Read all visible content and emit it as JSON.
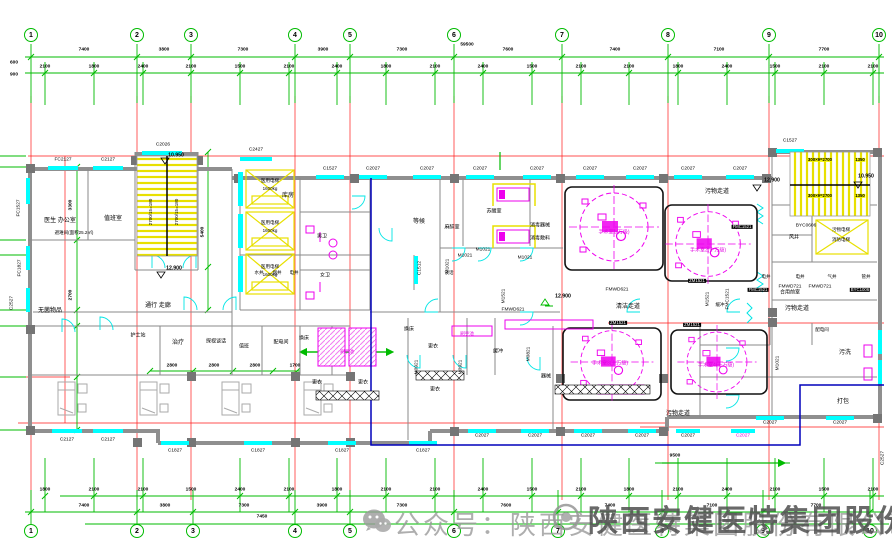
{
  "grid_numbers": [
    "1",
    "2",
    "3",
    "4",
    "5",
    "6",
    "7",
    "8",
    "9",
    "10"
  ],
  "dims": {
    "total": "59500",
    "row1": [
      "7400",
      "3800",
      "7300",
      "3900",
      "7300",
      "7600",
      "7400",
      "7100",
      "7700"
    ],
    "row2": [
      "2100",
      "1800",
      "2400",
      "2100",
      "1500",
      "2100",
      "2400",
      "1800",
      "2100",
      "2400",
      "1500",
      "2100",
      "2100",
      "1800",
      "2400",
      "1500",
      "2100",
      "2100"
    ],
    "bottom_small": [
      "1800",
      "2100",
      "2100",
      "1500",
      "2400",
      "2100",
      "1800",
      "2100",
      "2100",
      "2400",
      "1500",
      "2100",
      "1800",
      "2100",
      "2400",
      "2100",
      "1500",
      "2100"
    ],
    "bottom_spans": [
      "7400",
      "3800",
      "7300",
      "3900",
      "7300",
      "7600",
      "7400",
      "7100",
      "7700"
    ],
    "mid": [
      "2800",
      "2800",
      "2800",
      "1700"
    ],
    "or_area": "9500",
    "left_a": "600",
    "left_b": "900",
    "bottom_extra": "7450",
    "vert": [
      "3300",
      "2700",
      "5400"
    ],
    "stair_top": [
      "300×9=2700",
      "1350",
      "300×9=2700",
      "1350"
    ],
    "stair_left": "2700/15=180"
  },
  "levels": [
    "10.950",
    "12.900",
    "12.900",
    "12.900",
    "10.950"
  ],
  "windows_top": [
    "FC2127",
    "C2127",
    "C2026",
    "C2427",
    "C1527",
    "C2027",
    "C2027",
    "C2027",
    "C2027",
    "C2027",
    "C2027",
    "C2027",
    "C2027",
    "C1527"
  ],
  "windows_bottom": [
    "C2127",
    "C2127",
    "C1827",
    "C1827",
    "C1827",
    "C1827",
    "C2027",
    "C2027",
    "C2027",
    "C2027",
    "C2027",
    "C2027",
    "C2027",
    "C2027"
  ],
  "windows_side": [
    "FC1527",
    "FC1827",
    "C2527",
    "C1512",
    "C2527"
  ],
  "doors": [
    "M1021",
    "M1021",
    "M1021",
    "M1021",
    "M1521",
    "FMWD621",
    "FMWD621",
    "M0921",
    "M0921",
    "M0821",
    "M1521",
    "FMC1521",
    "ZM1521",
    "ZM1521",
    "ZM1521",
    "FMC1521",
    "BYC0606",
    "FMC1521",
    "FMWD721",
    "FMWD721",
    "BYC1006",
    "M1021"
  ],
  "rooms": [
    "医生 办公室",
    "避难间(面积25.2㎡)",
    "值班室",
    "无菌物品",
    "通行 走廊",
    "护士站",
    "治疗",
    "探视谈话",
    "值班",
    "配电间",
    "换床",
    "换床",
    "库房",
    "男卫",
    "女卫",
    "水井",
    "烟井",
    "电井",
    "等候",
    "麻醉室",
    "苏醒室",
    "消毒器械",
    "消毒敷料",
    "手术室1(万级)",
    "手术室2(十万级)",
    "清洁走道",
    "污物走道",
    "污物走道",
    "污物走道",
    "风井",
    "合用前室",
    "污物电梯",
    "消防电梯",
    "电井",
    "电井",
    "气井",
    "管井",
    "污洗",
    "打包",
    "配电间",
    "缓冲",
    "缓冲",
    "器械",
    "更衣",
    "更衣",
    "更衣",
    "更衣",
    "谈话",
    "手术室3(十万级)",
    "手术室4(十万级)",
    "医用电梯",
    "1600kg",
    "医用电梯",
    "1600kg",
    "医用电梯",
    "1600kg",
    "刷手池",
    "刷手池"
  ],
  "watermark": {
    "wechat": "公众号：陕西安健医特集团股份有限公司",
    "company": "陕西安健医特集团股份有限公司"
  },
  "colors": {
    "grid_green": "#00bb00",
    "axis_red": "#ff0000",
    "window_cyan": "#00ffff",
    "equip_magenta": "#ee00ee",
    "stair_yellow": "#e8e000",
    "clean_zone_blue": "#0000bb",
    "wall_gray": "#8a8a8a"
  }
}
